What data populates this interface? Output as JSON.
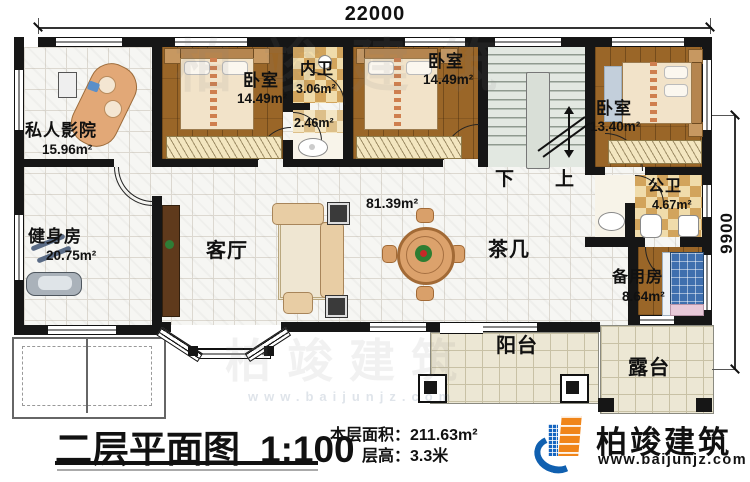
{
  "plan": {
    "dim_top": "22000",
    "dim_right": "9900",
    "hall_area": "81.39m²",
    "stairs": {
      "down": "下",
      "up": "上"
    },
    "rooms": {
      "cinema": {
        "label": "私人影院",
        "area": "15.96m²"
      },
      "gym": {
        "label": "健身房",
        "area": "20.75m²"
      },
      "bedroom1": {
        "label": "卧室",
        "area": "14.49m²"
      },
      "inner_bath": {
        "label": "内卫",
        "area": "3.06m²"
      },
      "inner_bath2": {
        "area": "2.46m²"
      },
      "bedroom2": {
        "label": "卧室",
        "area": "14.49m²"
      },
      "bedroom3": {
        "label": "卧室",
        "area": "13.40m²"
      },
      "public_bath": {
        "label": "公卫",
        "area": "4.67m²"
      },
      "living": {
        "label": "客厅"
      },
      "tea_table": {
        "label": "茶几"
      },
      "spare": {
        "label": "备用房",
        "area": "8.64m²"
      },
      "balcony": {
        "label": "阳台"
      },
      "terrace": {
        "label": "露台"
      }
    }
  },
  "footer": {
    "title": "二层平面图",
    "scale": "1:100",
    "area_label": "本层面积：",
    "area_value": "211.63m²",
    "height_label": "层高：",
    "height_value": "3.3米"
  },
  "brand": {
    "name": "柏竣建筑",
    "url": "www.baijunjz.com"
  }
}
